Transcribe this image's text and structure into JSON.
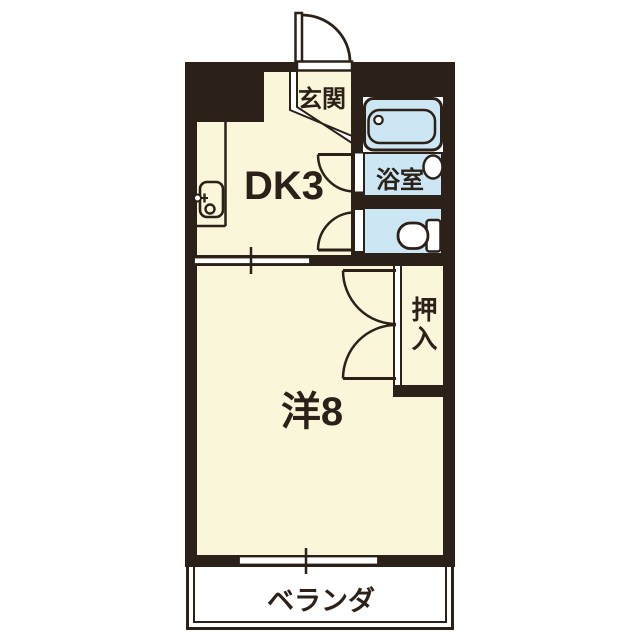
{
  "title": "1DK apartment floor plan",
  "colors": {
    "wall": "#2b2118",
    "floor": "#faf6da",
    "wet_area": "#cde6f4",
    "background": "#ffffff"
  },
  "rooms": {
    "genkan": {
      "label": "玄関"
    },
    "dk": {
      "label": "DK3"
    },
    "bathroom": {
      "label": "浴室"
    },
    "closet": {
      "label": "押入"
    },
    "western": {
      "label": "洋8"
    },
    "balcony": {
      "label": "ベランダ"
    }
  },
  "icons": {
    "bathtub": "bathtub-icon",
    "toilet": "toilet-icon",
    "kitchen_sink": "kitchen-sink-icon",
    "washbasin": "washbasin-icon",
    "entrance_door": "entrance-door-arc"
  }
}
